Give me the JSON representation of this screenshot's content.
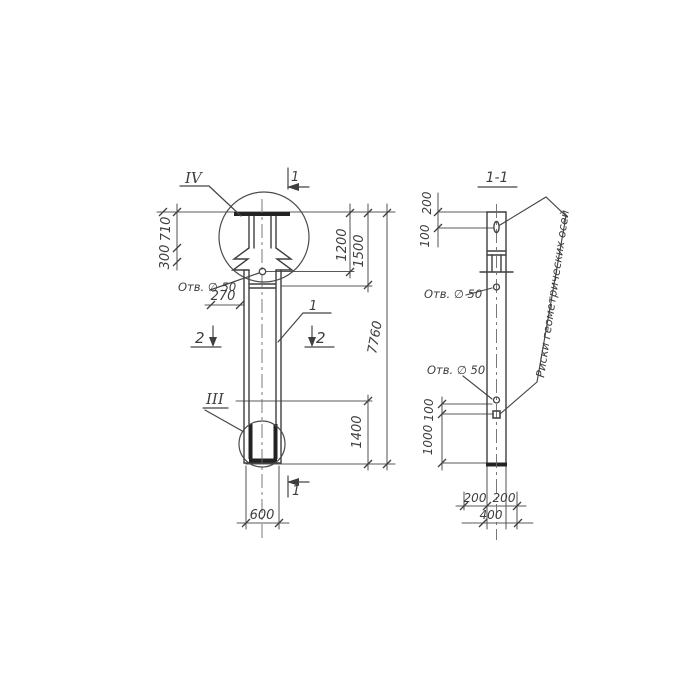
{
  "colors": {
    "ink": "#454545",
    "heavy": "#232323",
    "paper": "#ffffff"
  },
  "main_view": {
    "detail_top_label": "IV",
    "detail_bottom_label": "III",
    "section_cut_top": "1",
    "section_cut_bottom": "1",
    "section_cut_left": "2",
    "section_cut_right": "2",
    "part_callout": "1",
    "hole_note": "Отв. ∅ 50",
    "dim_head_height": "710",
    "dim_flare_height": "300",
    "dim_hole_offset": "270",
    "dim_top_to_hole": "1200",
    "dim_top_to_splice": "1500",
    "dim_overall_length": "7760",
    "dim_tip_length": "1400",
    "dim_width": "600"
  },
  "section_view": {
    "title": "1-1",
    "dim_top": "200",
    "dim_top2": "100",
    "hole_note_upper": "Отв. ∅ 50",
    "hole_note_lower": "Отв. ∅ 50",
    "dim_mid": "100",
    "dim_lower": "1000",
    "dim_bottom_left": "200",
    "dim_bottom_right": "200",
    "dim_bottom_total": "400",
    "axes_note": "Риски геометрических осей"
  }
}
